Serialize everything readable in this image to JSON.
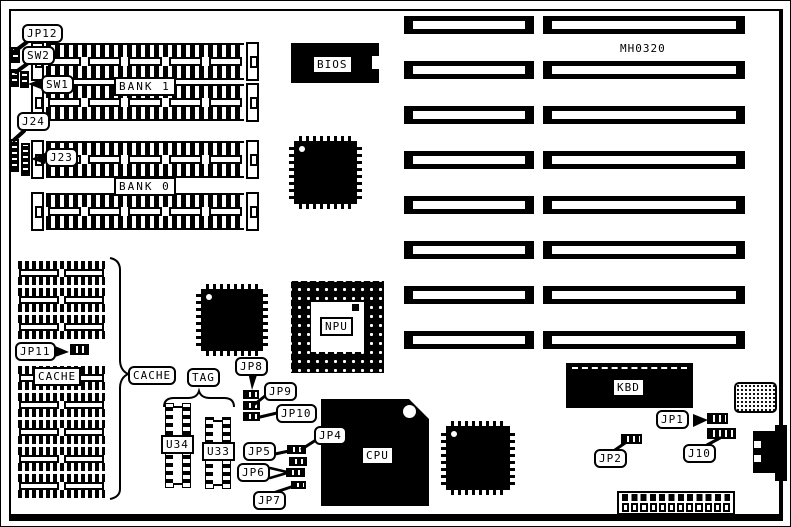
{
  "board": {
    "part_number": "MH0320",
    "memory": {
      "bank1_label": "BANK 1",
      "bank0_label": "BANK 0",
      "jp12": "JP12",
      "sw2": "SW2",
      "sw1": "SW1",
      "j24": "J24",
      "j23": "J23",
      "simm_sockets": 4
    },
    "cache": {
      "chip_label": "CACHE",
      "group_label": "CACHE",
      "tag_label": "TAG",
      "jp11": "JP11",
      "u34": "U34",
      "u33": "U33",
      "ram_blocks": 8
    },
    "chips": {
      "bios": "BIOS",
      "npu": "NPU",
      "cpu": "CPU",
      "kbd": "KBD"
    },
    "jumpers": {
      "jp8": "JP8",
      "jp9": "JP9",
      "jp10": "JP10",
      "jp5": "JP5",
      "jp4": "JP4",
      "jp6": "JP6",
      "jp7": "JP7",
      "jp1": "JP1",
      "jp2": "JP2",
      "j10": "J10"
    },
    "expansion_slots": 8,
    "power_connector_pins": 12,
    "colors": {
      "ink": "#000000",
      "paper": "#ffffff"
    }
  }
}
